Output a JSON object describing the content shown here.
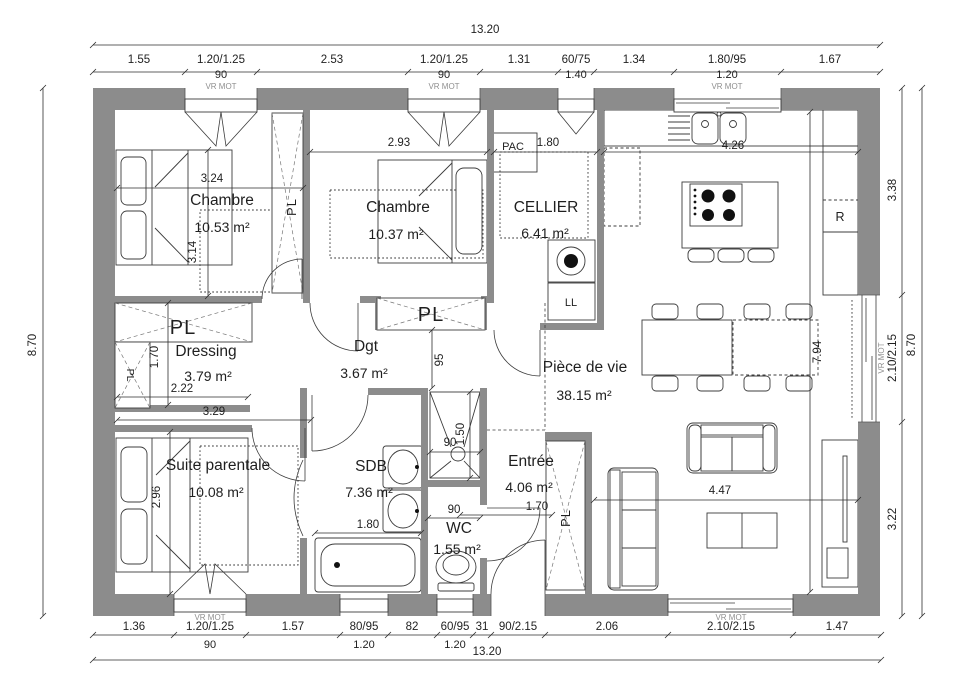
{
  "rooms": {
    "chambre1": {
      "name": "Chambre",
      "area": "10.53 m²"
    },
    "chambre2": {
      "name": "Chambre",
      "area": "10.37 m²"
    },
    "cellier": {
      "name": "CELLIER",
      "area": "6.41 m²"
    },
    "dressing": {
      "name": "Dressing",
      "area": "3.79 m²"
    },
    "dgt": {
      "name": "Dgt",
      "area": "3.67 m²"
    },
    "piece_de_vie": {
      "name": "Pièce de vie",
      "area": "38.15 m²"
    },
    "suite": {
      "name": "Suite parentale",
      "area": "10.08 m²"
    },
    "sdb": {
      "name": "SDB",
      "area": "7.36 m²"
    },
    "entree": {
      "name": "Entrée",
      "area": "4.06 m²"
    },
    "wc": {
      "name": "WC",
      "area": "1.55 m²"
    }
  },
  "labels": {
    "closet": "PL",
    "pac": "PAC",
    "washer": "LL",
    "fridge": "R",
    "shutter": "VR MOT"
  },
  "dims": {
    "top": {
      "total": "13.20",
      "segments": [
        "1.55",
        "1.20/1.25",
        "2.53",
        "1.20/1.25",
        "1.31",
        "60/75",
        "1.34",
        "1.80/95",
        "1.67"
      ],
      "sub_1": "90",
      "sub_3": "90",
      "sub_5": "1.40",
      "sub_7": "1.20"
    },
    "bottom": {
      "total": "13.20",
      "segments": [
        "1.36",
        "1.20/1.25",
        "1.57",
        "80/95",
        "82",
        "60/95",
        "31",
        "90/2.15",
        "2.06",
        "2.10/2.15",
        "1.47"
      ],
      "sub_1": "90",
      "sub_3": "1.20",
      "sub_5": "1.20"
    },
    "left": {
      "total": "8.70"
    },
    "right": {
      "total": "8.70",
      "segments": [
        "3.38",
        "2.10/2.15",
        "3.22"
      ]
    },
    "interior": {
      "chambre1_w": "3.24",
      "chambre1_h": "3.14",
      "chambre2_w": "2.93",
      "cellier_w": "1.80",
      "kitchen_w": "4.26",
      "dressing_h": "1.70",
      "dressing_w": "2.22",
      "suite_w": "3.29",
      "hall_w": "95",
      "living_h": "7.94",
      "living_w": "4.47",
      "suite_h": "2.96",
      "bath_w": "1.80",
      "shower_w": "90",
      "shower_d": "1.50",
      "wc_w": "90",
      "entree_w": "1.70"
    }
  }
}
